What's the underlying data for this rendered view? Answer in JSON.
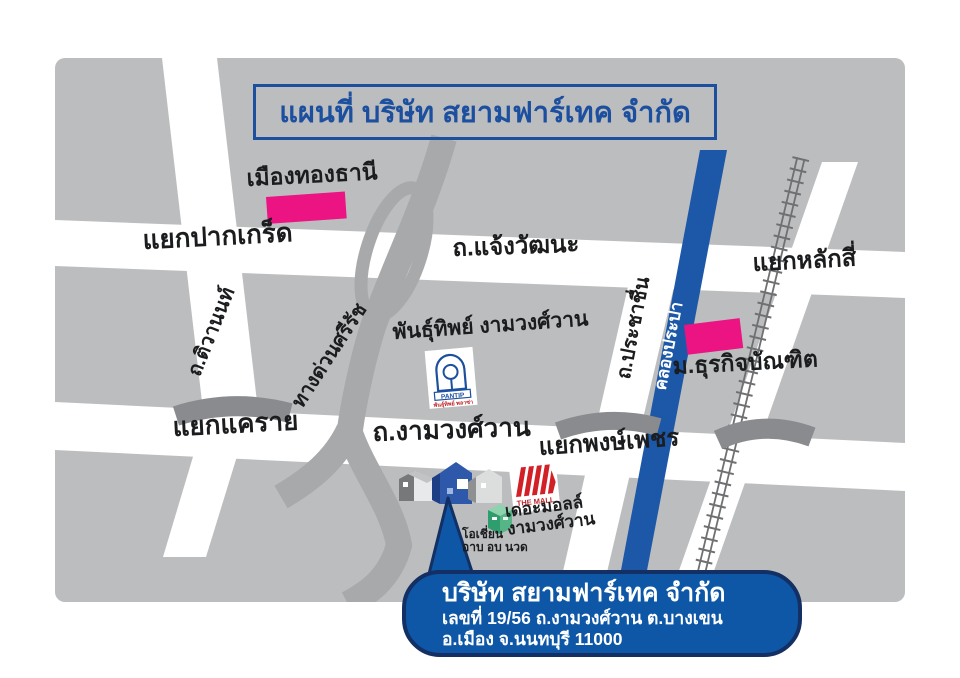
{
  "title": {
    "label": "แผนที่ บริษัท สยามฟาร์เทค จำกัด"
  },
  "map": {
    "landmarks": {
      "muang_thong": "เมืองทองธานี",
      "pantip": "พันธุ์ทิพย์ งามวงศ์วาน",
      "dpu": "ม.ธุรกิจบัณฑิต",
      "mall_line1": "เดอะมอลล์",
      "mall_line2": "งามวงศ์วาน",
      "ocean_line1": "โอเชี่ยน",
      "ocean_line2": "อาบ อบ นวด"
    },
    "roads": {
      "pak_kret": "แยกปากเกร็ด",
      "chaengwattana": "ถ.แจ้งวัฒนะ",
      "lak_si": "แยกหลักสี่",
      "tiwanon": "ถ.ติวานนท์",
      "si_rat": "ทางด่วนศรีรัช",
      "prachachuen": "ถ.ประชาชื่น",
      "khlong_prapa": "คลองประปา",
      "khae_rai": "แยกแคราย",
      "ngamwongwan": "ถ.งามวงศ์วาน",
      "phong_phet": "แยกพงษ์เพชร"
    },
    "logos": {
      "pantip_name": "PANTIP",
      "pantip_sub": "พันธุ์ทิพย์ พลาซ่า",
      "mall_name": "THE MALL"
    },
    "colors": {
      "map_bg": "#bcbdbf",
      "road_white": "#ffffff",
      "expressway_gray": "#a8a9ab",
      "bridge_gray": "#8a8b8e",
      "railway_gray": "#6f7072",
      "canal_blue": "#1d58a8",
      "landmark_pink": "#ec1383",
      "title_blue": "#1d4f9f",
      "callout_blue": "#0d57a6",
      "callout_border": "#132f63",
      "company_marker_blue": "#2e59ab",
      "ocean_green": "#2f9e6e",
      "mall_red": "#d22027"
    }
  },
  "callout": {
    "company": "บริษัท สยามฟาร์เทค จำกัด",
    "address_line1": "เลขที่ 19/56 ถ.งามวงศ์วาน ต.บางเขน",
    "address_line2": "อ.เมือง จ.นนทบุรี 11000"
  }
}
